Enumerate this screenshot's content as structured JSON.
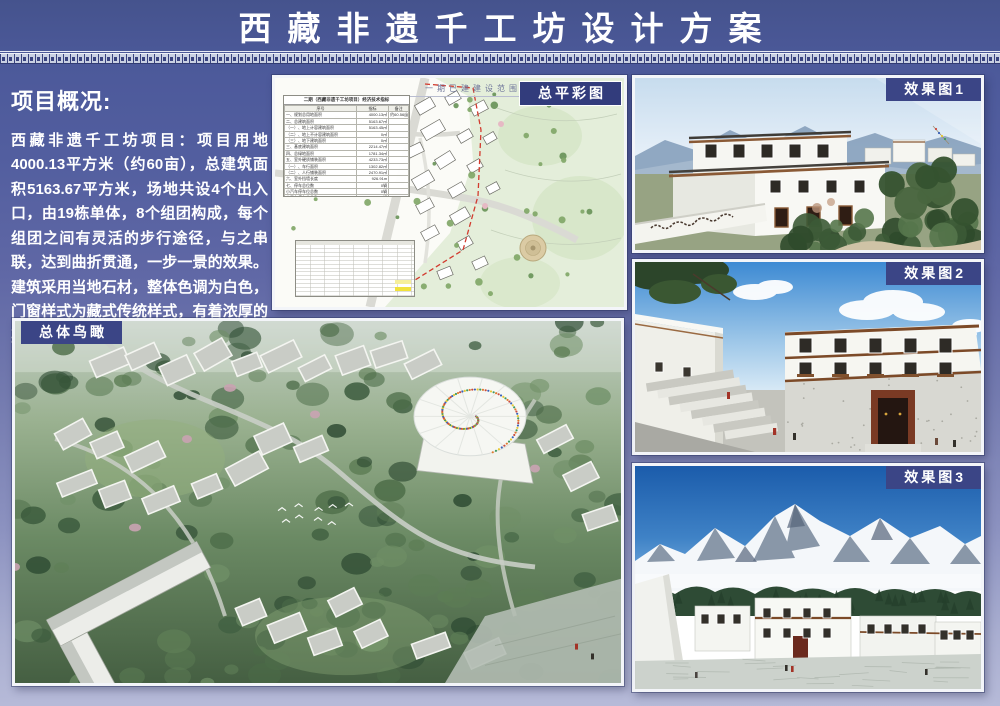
{
  "title": "西藏非遗千工坊设计方案",
  "overview": {
    "heading": "项目概况:",
    "body": "西藏非遗千工坊项目：项目用地4000.13平方米（约60亩），总建筑面积5163.67平方米，场地共设4个出入口，由19栋单体，8个组团构成，每个组团之间有灵活的步行途径，与之串联，达到曲折贯通，一步一景的效果。建筑采用当地石材，整体色调为白色，门窗样式为藏式传统样式，有着浓厚的藏式风味，符合片区的整体风貌。"
  },
  "panels": {
    "site_plan": {
      "label": "总平彩图",
      "drawing_title": "一期已建建设范围",
      "table": {
        "title": "二期（西藏非遗千工坊项目）经济技术指标",
        "columns": [
          "序号",
          "指标",
          "备注"
        ],
        "rows": [
          [
            "一、规划总用地面积",
            "4000.13㎡",
            "约60.56亩"
          ],
          [
            "二、总建筑面积",
            "5163.67㎡",
            ""
          ],
          [
            "（一）、地上计容建筑面积",
            "5163.45㎡",
            ""
          ],
          [
            "（二）、地上不计容建筑面积",
            "0㎡",
            ""
          ],
          [
            "（三）、地下建筑面积",
            "0㎡",
            ""
          ],
          [
            "三、基底建筑面积",
            "2214.47㎡",
            ""
          ],
          [
            "四、总绿地面积",
            "1781.34㎡",
            ""
          ],
          [
            "五、室外硬质铺装面积",
            "4233.73㎡",
            ""
          ],
          [
            "（一）、车行面积",
            "1302.82㎡",
            ""
          ],
          [
            "（二）、人行铺装面积",
            "2470.91㎡",
            ""
          ],
          [
            "六、室外挡墙长度",
            "926.91m",
            ""
          ],
          [
            "七、停车总位数",
            "0辆",
            ""
          ],
          [
            "小汽车停车位总数",
            "0辆",
            ""
          ],
          [
            "大巴车停车位总数",
            "0辆",
            ""
          ]
        ]
      }
    },
    "render1": {
      "label": "效果图1"
    },
    "render2": {
      "label": "效果图2"
    },
    "render3": {
      "label": "效果图3"
    },
    "aerial": {
      "label": "总体鸟瞰"
    }
  },
  "colors": {
    "background_top": "#46548e",
    "background_bottom": "#b6bad8",
    "header_blue": "#4a5a9a",
    "tag_navy": "#3b4586",
    "tag_navy_dark": "#323c7c",
    "ornament_light": "#c9d0e2",
    "boundary_red": "#d23b2f",
    "highlight_yellow": "#f1e23c"
  }
}
